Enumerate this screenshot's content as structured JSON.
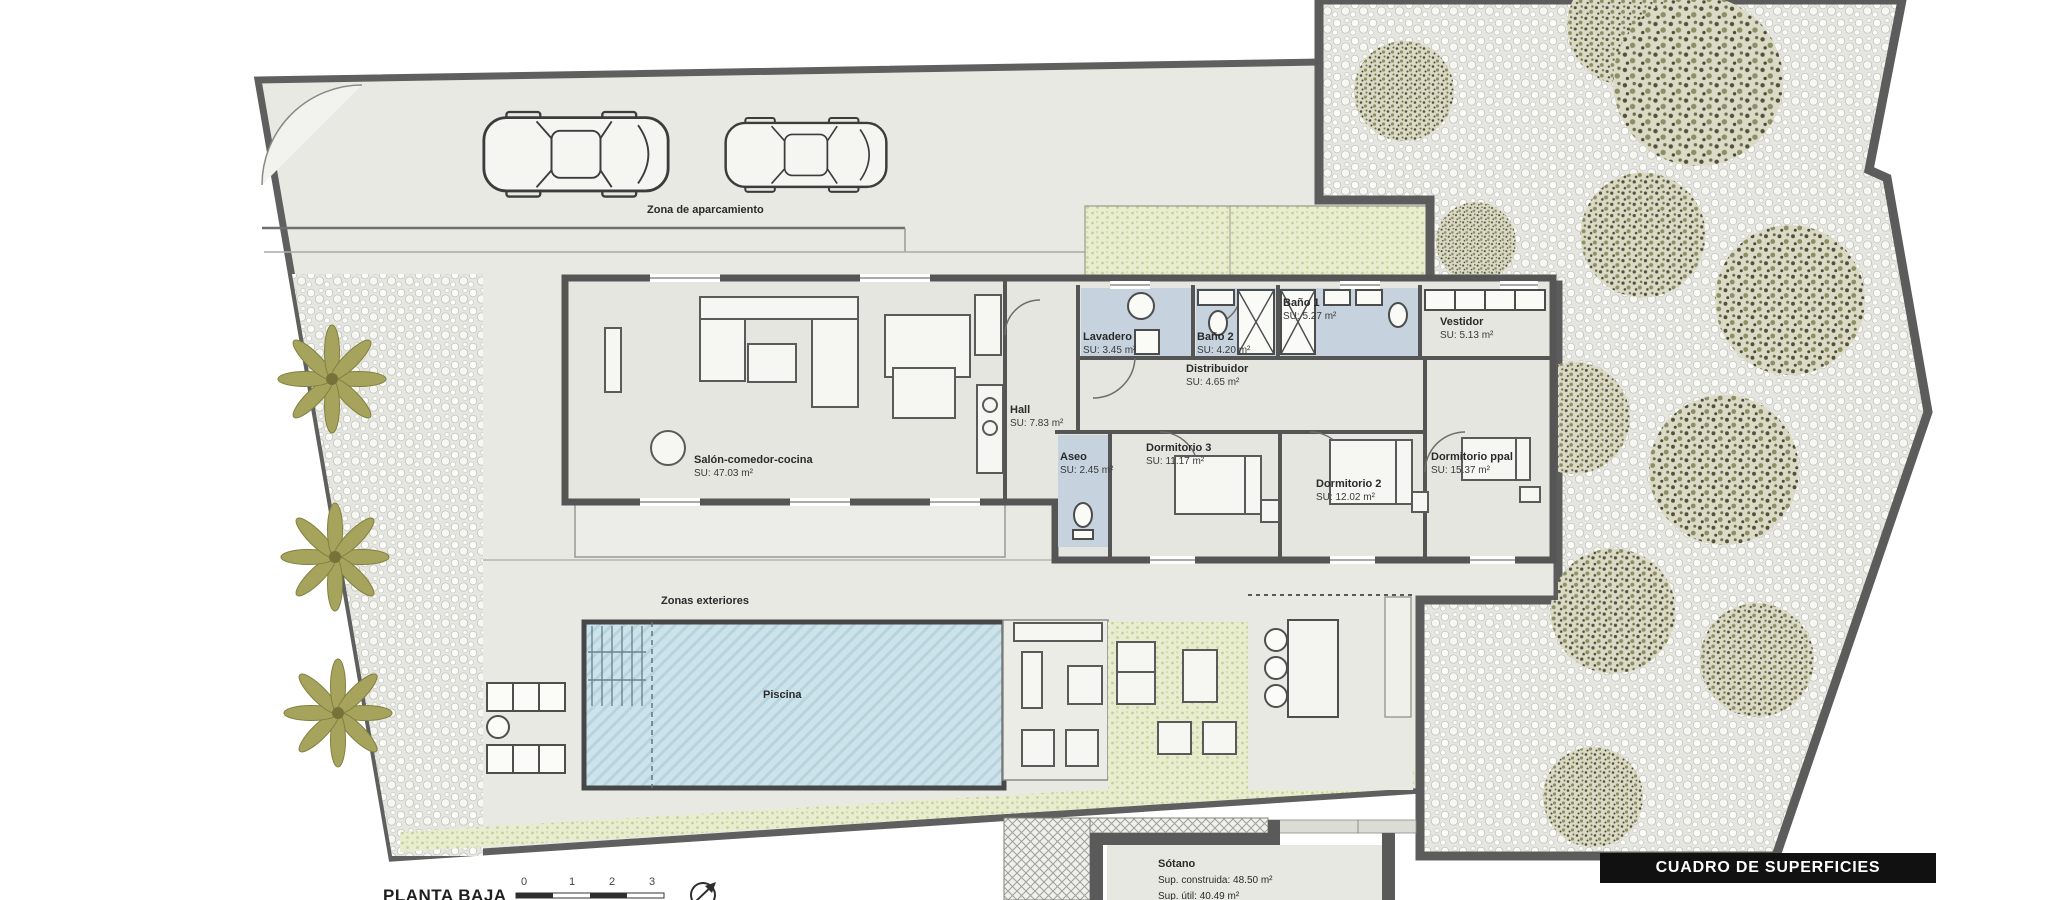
{
  "document": {
    "plan_title": "PLANTA BAJA",
    "surface_table_title": "CUADRO DE SUPERFICIES",
    "scale_ticks": [
      "0",
      "1",
      "2",
      "3"
    ]
  },
  "colors": {
    "wall": "#585858",
    "paving": "#e9e9e4",
    "pool": "#cde3eb",
    "wet_floor": "#c6d2dd",
    "vegetation": "#a6a45c",
    "banner_bg": "#111111",
    "banner_text": "#ffffff"
  },
  "rooms": {
    "parking": {
      "name": "Zona de aparcamiento"
    },
    "salon": {
      "name": "Salón-comedor-cocina",
      "area": "SU: 47.03 m²"
    },
    "hall": {
      "name": "Hall",
      "area": "SU: 7.83 m²"
    },
    "lavadero": {
      "name": "Lavadero",
      "area": "SU: 3.45 m²"
    },
    "bano2": {
      "name": "Baño 2",
      "area": "SU: 4.20 m²"
    },
    "bano1": {
      "name": "Baño 1",
      "area": "SU: 5.27 m²"
    },
    "vestidor": {
      "name": "Vestidor",
      "area": "SU: 5.13 m²"
    },
    "distribuidor": {
      "name": "Distribuidor",
      "area": "SU: 4.65 m²"
    },
    "aseo": {
      "name": "Aseo",
      "area": "SU: 2.45 m²"
    },
    "dormitorio3": {
      "name": "Dormitorio 3",
      "area": "SU: 11.17 m²"
    },
    "dormitorio2": {
      "name": "Dormitorio 2",
      "area": "SU: 12.02 m²"
    },
    "dormitorio_ppal": {
      "name": "Dormitorio ppal",
      "area": "SU: 15.37 m²"
    }
  },
  "exterior": {
    "zones_label": "Zonas exteriores",
    "pool_label": "Piscina"
  },
  "basement": {
    "name": "Sótano",
    "built_area": "Sup. construida: 48.50 m²",
    "usable_area": "Sup. útil: 40.49 m²"
  }
}
